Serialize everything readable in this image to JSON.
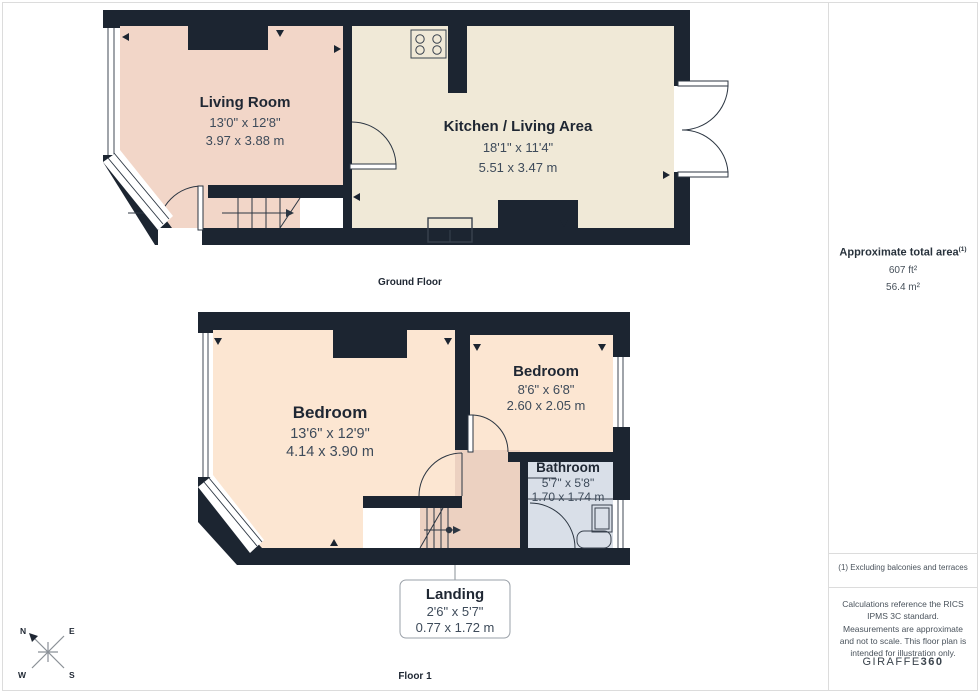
{
  "ground": {
    "label": "Ground Floor",
    "living": {
      "name": "Living Room",
      "imp": "13'0\" x 12'8\"",
      "met": "3.97 x 3.88 m"
    },
    "kitchen": {
      "name": "Kitchen / Living Area",
      "imp": "18'1\" x 11'4\"",
      "met": "5.51 x 3.47 m"
    }
  },
  "first": {
    "label": "Floor 1",
    "bedroom1": {
      "name": "Bedroom",
      "imp": "13'6\" x 12'9\"",
      "met": "4.14 x 3.90 m"
    },
    "bedroom2": {
      "name": "Bedroom",
      "imp": "8'6\" x 6'8\"",
      "met": "2.60 x 2.05 m"
    },
    "bathroom": {
      "name": "Bathroom",
      "imp": "5'7\" x 5'8\"",
      "met": "1.70 x 1.74 m"
    },
    "landing": {
      "name": "Landing",
      "imp": "2'6\" x 5'7\"",
      "met": "0.77 x 1.72 m"
    }
  },
  "sidebar": {
    "total_area_title": "Approximate total area",
    "total_area_ref": "(1)",
    "area_imperial": "607 ft²",
    "area_metric": "56.4 m²",
    "footnote": "(1) Excluding balconies and terraces",
    "disclaimer": "Calculations reference the RICS IPMS 3C standard. Measurements are approximate and not to scale. This floor plan is intended for illustration only.",
    "brand_name": "GIRAFFE",
    "brand_suffix": "360"
  },
  "compass": {
    "n": "N",
    "e": "E",
    "w": "W",
    "s": "S"
  },
  "icons": {
    "stove": "stove-hob-icon (square with 4 burner circles)",
    "compass": "compass-rose-icon (8-point star, N to upper-left)"
  },
  "colors": {
    "wall": "#1c2531",
    "living_room_fill": "#f2d6c8",
    "kitchen_fill": "#f0e9d7",
    "bedroom_fill": "#fce6d2",
    "landing_fill": "#ecd1c1",
    "bathroom_fill": "#d9dfe8",
    "title_text": "#1f2733",
    "dims_text": "#3e4b5a",
    "divider": "#dcdcdc"
  }
}
